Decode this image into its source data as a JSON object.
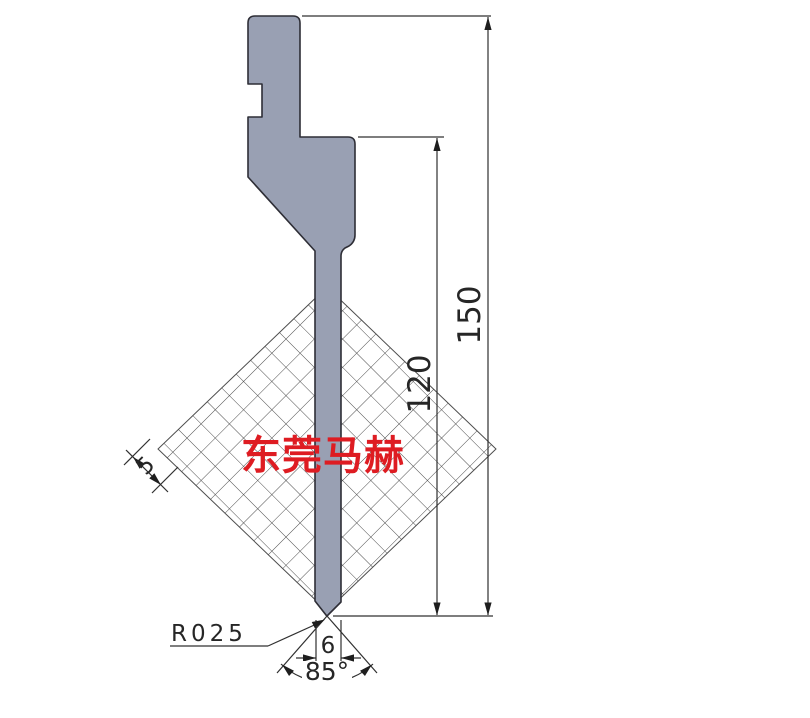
{
  "drawing": {
    "type_note": "press-brake punch technical drawing",
    "watermark": {
      "text": "东莞马赫",
      "color": "#de1c22"
    },
    "dimensions": {
      "total_height": "150",
      "working_height": "120",
      "grid_pitch": "5",
      "tip_width": "6",
      "tip_angle": "85°",
      "tip_radius": "R025"
    },
    "colors": {
      "punch_fill": "#99a0b3",
      "punch_outline": "#2e2e36",
      "dimension_line": "#303030",
      "grid_line": "#4d4d4d",
      "background": "#ffffff",
      "watermark_red": "#de1c22"
    }
  }
}
